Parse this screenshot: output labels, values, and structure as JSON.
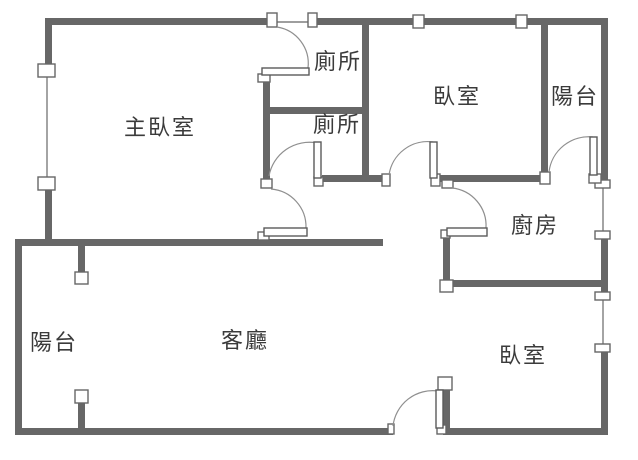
{
  "title": "apartment-floor-plan",
  "plan": {
    "colors": {
      "wall": "#676767",
      "door_arc": "#8f8f8f",
      "window_line": "#7e7e7e",
      "text": "#3b3b3b",
      "background": "#ffffff"
    },
    "rooms": [
      {
        "name": "master-bedroom",
        "label": "主臥室"
      },
      {
        "name": "toilet-upper",
        "label": "廁所"
      },
      {
        "name": "toilet-lower",
        "label": "廁所"
      },
      {
        "name": "bedroom-top",
        "label": "臥室"
      },
      {
        "name": "balcony-rear",
        "label": "陽台"
      },
      {
        "name": "kitchen",
        "label": "廚房"
      },
      {
        "name": "balcony-front",
        "label": "陽台"
      },
      {
        "name": "living-room",
        "label": "客廳"
      },
      {
        "name": "bedroom-right",
        "label": "臥室"
      }
    ]
  }
}
